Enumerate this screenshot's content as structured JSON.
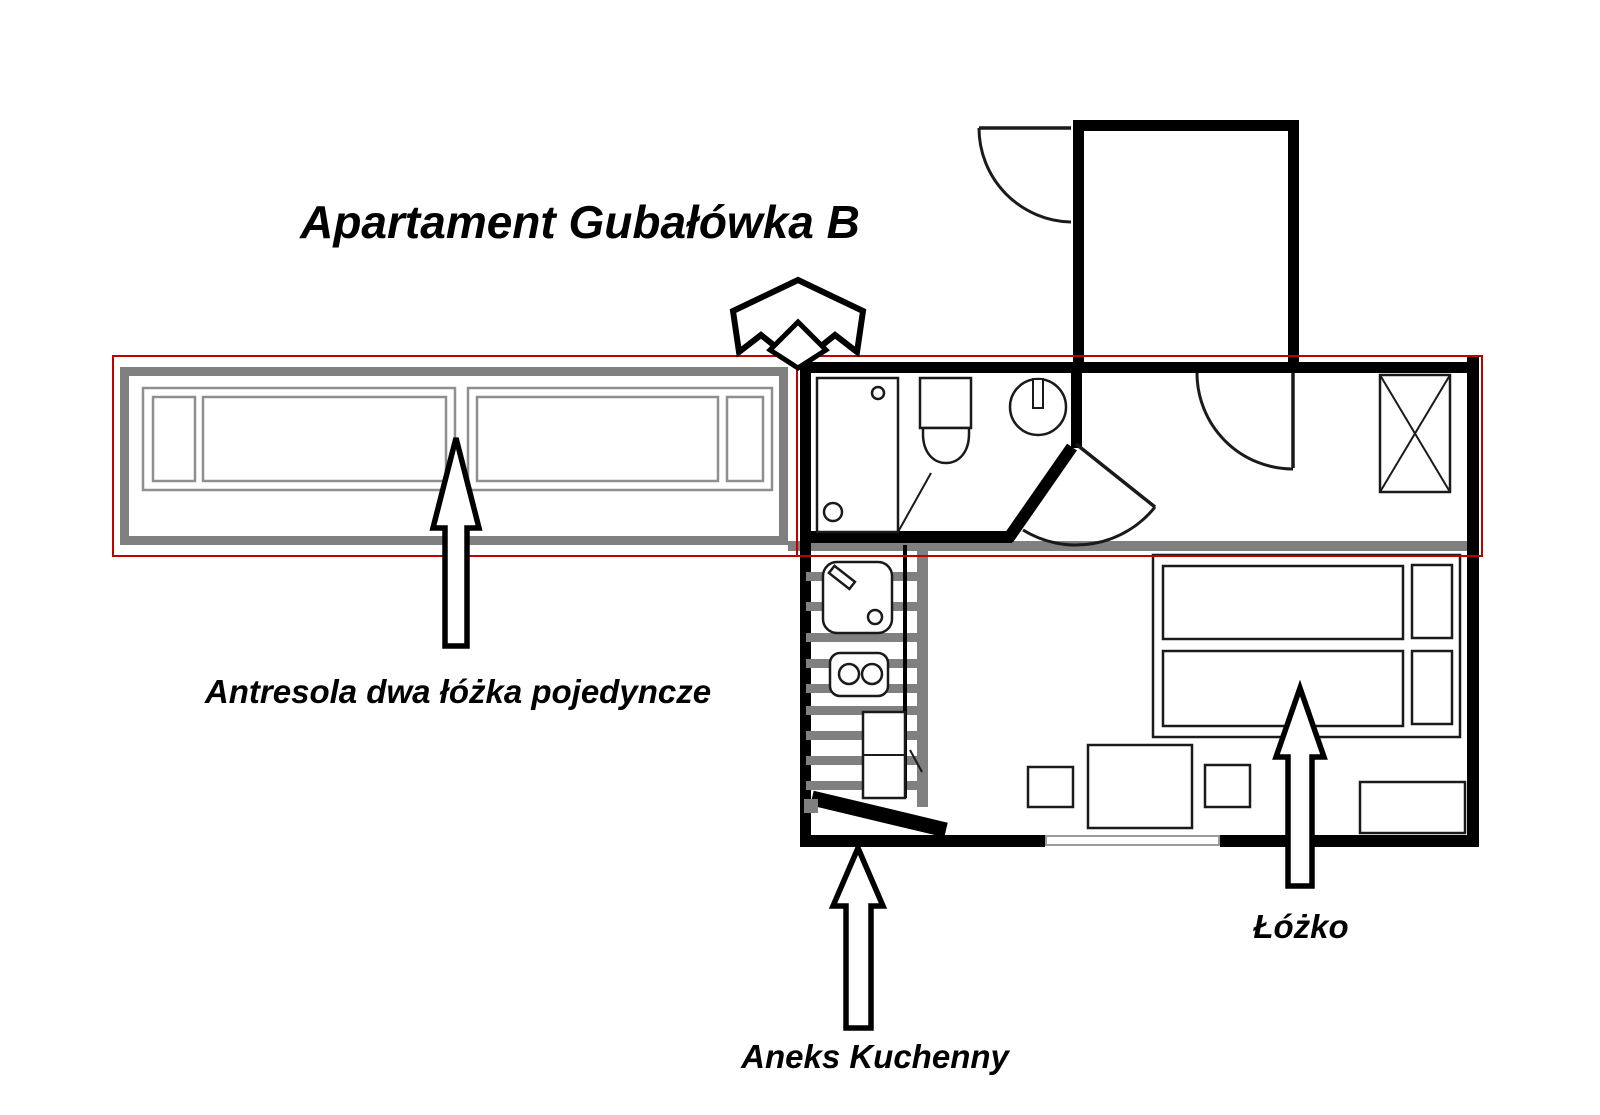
{
  "title": "Apartament Gubałówka B",
  "labels": {
    "mezzanine": "Antresola dwa łóżka pojedyncze",
    "bed": "Łóżko",
    "kitchen": "Aneks Kuchenny"
  },
  "colors": {
    "wall": "#000000",
    "line": "#1a1a1a",
    "mezzanine_gray": "#808080",
    "frame_gray": "#8f8f8f",
    "highlight_red": "#c00000",
    "background": "#ffffff"
  }
}
